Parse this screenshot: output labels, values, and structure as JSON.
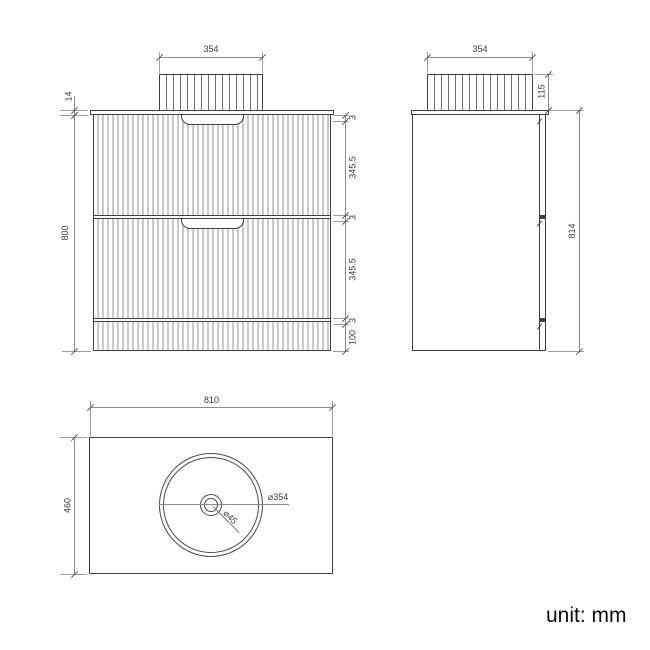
{
  "unit_note": "unit: mm",
  "front_view": {
    "basin_width": "354",
    "countertop_thickness": "14",
    "cabinet_height": "800",
    "right_chain": [
      "3",
      "345.5",
      "3",
      "345.5",
      "3",
      "100"
    ]
  },
  "side_view": {
    "basin_width": "354",
    "basin_height": "115",
    "total_height": "814"
  },
  "plan_view": {
    "top_width": "810",
    "depth": "460",
    "basin_diameter": "⌀354",
    "drain_diameter": "⌀45"
  },
  "colors": {
    "outline": "#3f3f3f",
    "dimension_line": "#8a8a8a",
    "flute_gray": "#c9c9c9",
    "text": "#3a3a3a"
  }
}
